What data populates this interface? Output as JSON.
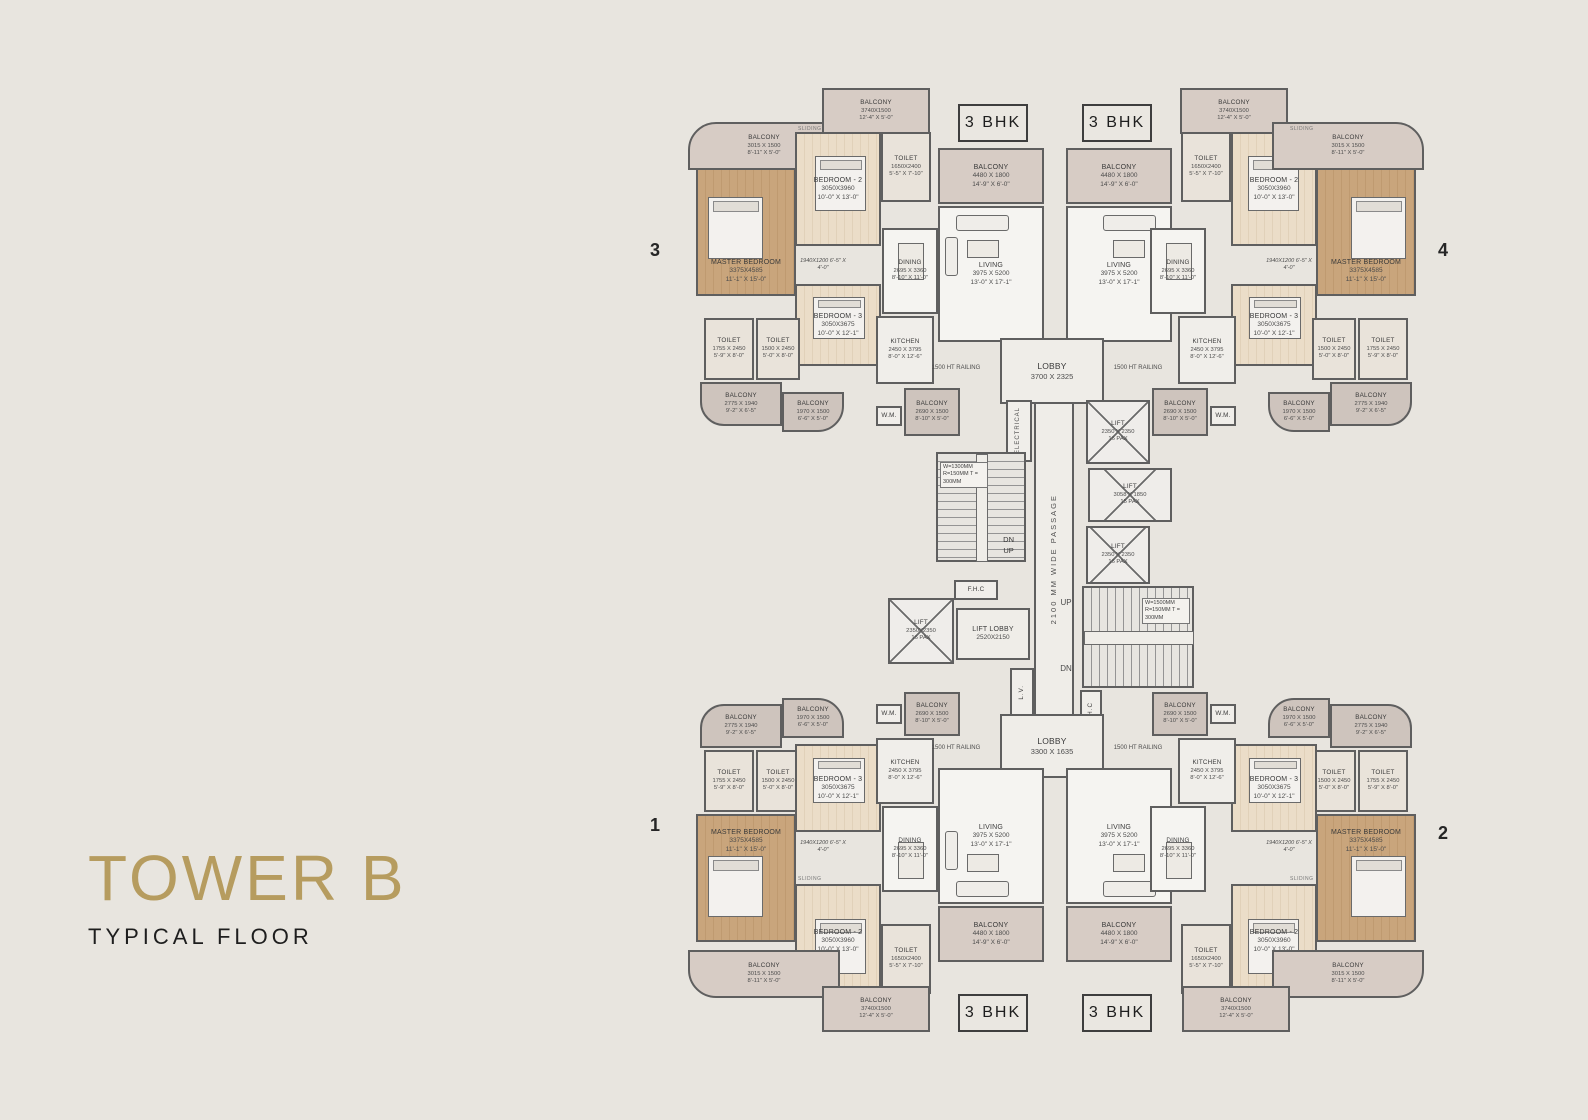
{
  "title": {
    "tower": "TOWER B",
    "floor": "TYPICAL FLOOR"
  },
  "units": {
    "type_label": "3 BHK",
    "n1": "1",
    "n2": "2",
    "n3": "3",
    "n4": "4"
  },
  "room_types": {
    "master_bedroom": {
      "name": "MASTER BEDROOM",
      "mm": "3375X4585",
      "ft": "11'-1\" X 15'-0\""
    },
    "bedroom_2": {
      "name": "BEDROOM - 2",
      "mm": "3050X3960",
      "ft": "10'-0\" X 13'-0\""
    },
    "bedroom_3": {
      "name": "BEDROOM - 3",
      "mm": "3050X3675",
      "ft": "10'-0\" X 12'-1\""
    },
    "living": {
      "name": "LIVING",
      "mm": "3975 X 5200",
      "ft": "13'-0\" X 17'-1\""
    },
    "dining": {
      "name": "DINING",
      "mm": "2695 X 3360",
      "ft": "8'-10\" X 11'-0\""
    },
    "kitchen": {
      "name": "KITCHEN",
      "mm": "2450 X 3795",
      "ft": "8'-0\" X 12'-6\""
    },
    "toilet_1755": {
      "name": "TOILET",
      "mm": "1755 X 2450",
      "ft": "5'-9\" X 8'-0\""
    },
    "toilet_1500": {
      "name": "TOILET",
      "mm": "1500 X 2450",
      "ft": "5'-0\" X 8'-0\""
    },
    "toilet_1650": {
      "name": "TOILET",
      "mm": "1650X2400",
      "ft": "5'-5\" X 7'-10\""
    },
    "balcony_4480": {
      "name": "BALCONY",
      "mm": "4480 X 1800",
      "ft": "14'-9\" X 6'-0\""
    },
    "balcony_3740": {
      "name": "BALCONY",
      "mm": "3740X1500",
      "ft": "12'-4\" X 5'-0\""
    },
    "balcony_3015": {
      "name": "BALCONY",
      "mm": "3015 X 1500",
      "ft": "8'-11\" X 5'-0\""
    },
    "balcony_2775": {
      "name": "BALCONY",
      "mm": "2775 X 1940",
      "ft": "9'-2\" X 6'-5\""
    },
    "balcony_1970": {
      "name": "BALCONY",
      "mm": "1970 X 1500",
      "ft": "6'-6\" X 5'-0\""
    },
    "balcony_2690": {
      "name": "BALCONY",
      "mm": "2690 X 1500",
      "ft": "8'-10\" X 5'-0\""
    },
    "wm": {
      "name": "W.M."
    },
    "dress": {
      "mm": "1940X1200",
      "ft": "6'-5\" X 4'-0\""
    }
  },
  "core": {
    "lobby_top": {
      "name": "LOBBY",
      "mm": "3700 X 2325"
    },
    "lobby_bottom": {
      "name": "LOBBY",
      "mm": "3300 X 1635"
    },
    "lift_lobby": {
      "name": "LIFT LOBBY",
      "mm": "2520X2150"
    },
    "lift_16": {
      "name": "LIFT",
      "mm": "2350 X 2350",
      "pax": "16 PAX"
    },
    "lift_15": {
      "name": "LIFT",
      "mm": "3058 X 1850",
      "pax": "15 PAX"
    },
    "lift_16b": {
      "name": "LIFT",
      "mm": "2350X2350",
      "pax": "16 PAX"
    },
    "passage": "2100 MM WIDE PASSAGE",
    "electrical": "ELECTRICAL",
    "fhc": "F.H.C",
    "lv": "L.V.",
    "up": "UP",
    "dn": "DN",
    "railing": "1500 HT RAILING",
    "stair_note_left": "W=1300MM R=150MM T = 300MM",
    "stair_note_right": "W=1500MM R=150MM T = 300MM"
  },
  "misc": {
    "sliding": "SLIDING"
  },
  "colors": {
    "accent": "#b69c5f",
    "master_wood": "#c9a57c",
    "bedroom_wood": "#ebddc8",
    "balcony": "#cec4bd",
    "marble": "#f5f4f1",
    "background": "#e8e5df",
    "wall": "#5f5f5f"
  }
}
